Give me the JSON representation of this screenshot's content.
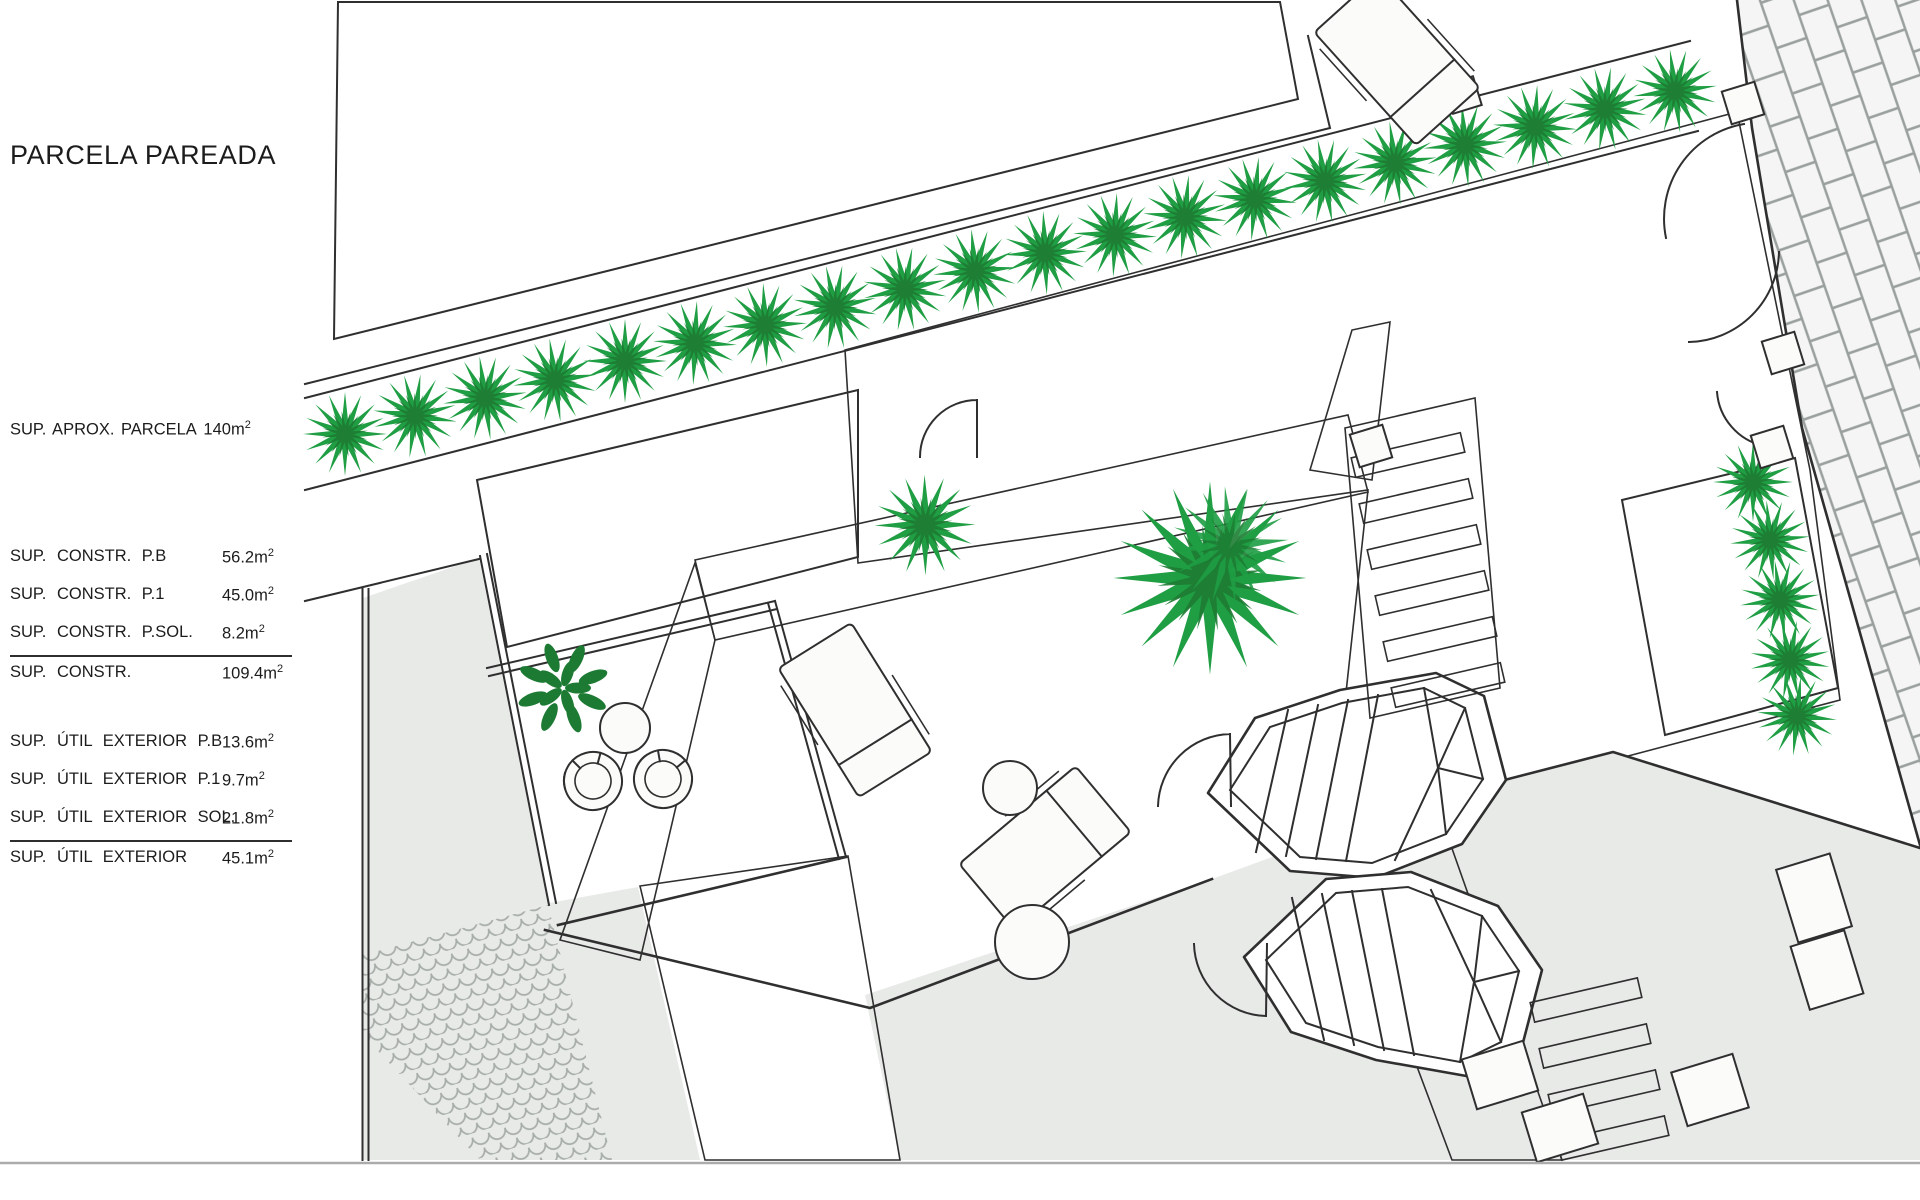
{
  "panel": {
    "title": "PARCELA PAREADA",
    "approx_label": "SUP. APROX. PARCELA",
    "approx_value": "140",
    "unit": "m",
    "unit_sup": "2",
    "groups": [
      {
        "rows": [
          {
            "label": "SUP. CONSTR. P.B",
            "value": "56.2",
            "unit": "m",
            "unit_sup": "2"
          },
          {
            "label": "SUP. CONSTR. P.1",
            "value": "45.0",
            "unit": "m",
            "unit_sup": "2"
          },
          {
            "label": "SUP. CONSTR. P.SOL.",
            "value": "8.2",
            "unit": "m",
            "unit_sup": "2"
          }
        ],
        "total": {
          "label": "SUP. CONSTR.",
          "value": "109.4",
          "unit": "m",
          "unit_sup": "2"
        }
      },
      {
        "rows": [
          {
            "label": "SUP. ÚTIL EXTERIOR P.B",
            "value": "13.6",
            "unit": "m",
            "unit_sup": "2"
          },
          {
            "label": "SUP. ÚTIL EXTERIOR P.1",
            "value": "9.7",
            "unit": "m",
            "unit_sup": "2"
          },
          {
            "label": "SUP. ÚTIL EXTERIOR SOL.",
            "value": "21.8",
            "unit": "m",
            "unit_sup": "2"
          }
        ],
        "total": {
          "label": "SUP. ÚTIL EXTERIOR",
          "value": "45.1",
          "unit": "m",
          "unit_sup": "2"
        }
      }
    ]
  },
  "colors": {
    "text": "#1c1c1c",
    "wall": "#2f2f2f",
    "pool": "#8fc0d2",
    "pool_line": "#5795aa",
    "plant": "#1f9e44",
    "plant_dark": "#1d7a33",
    "stipple": "#b7b189",
    "gray": "#e8eae8",
    "pattern_line": "#9aa09e",
    "sheet_line": "#ababab"
  },
  "plan": {
    "features": [
      "pool",
      "hedge-row",
      "stipple-planter",
      "flagstone-paving",
      "street-brick-paving",
      "cobblestone-paths",
      "octagonal-stair",
      "sun-loungers",
      "round-tables",
      "egg-chairs",
      "palm-trees",
      "shrub",
      "pergola-slats",
      "boundary-walls",
      "entrance-gates"
    ]
  }
}
